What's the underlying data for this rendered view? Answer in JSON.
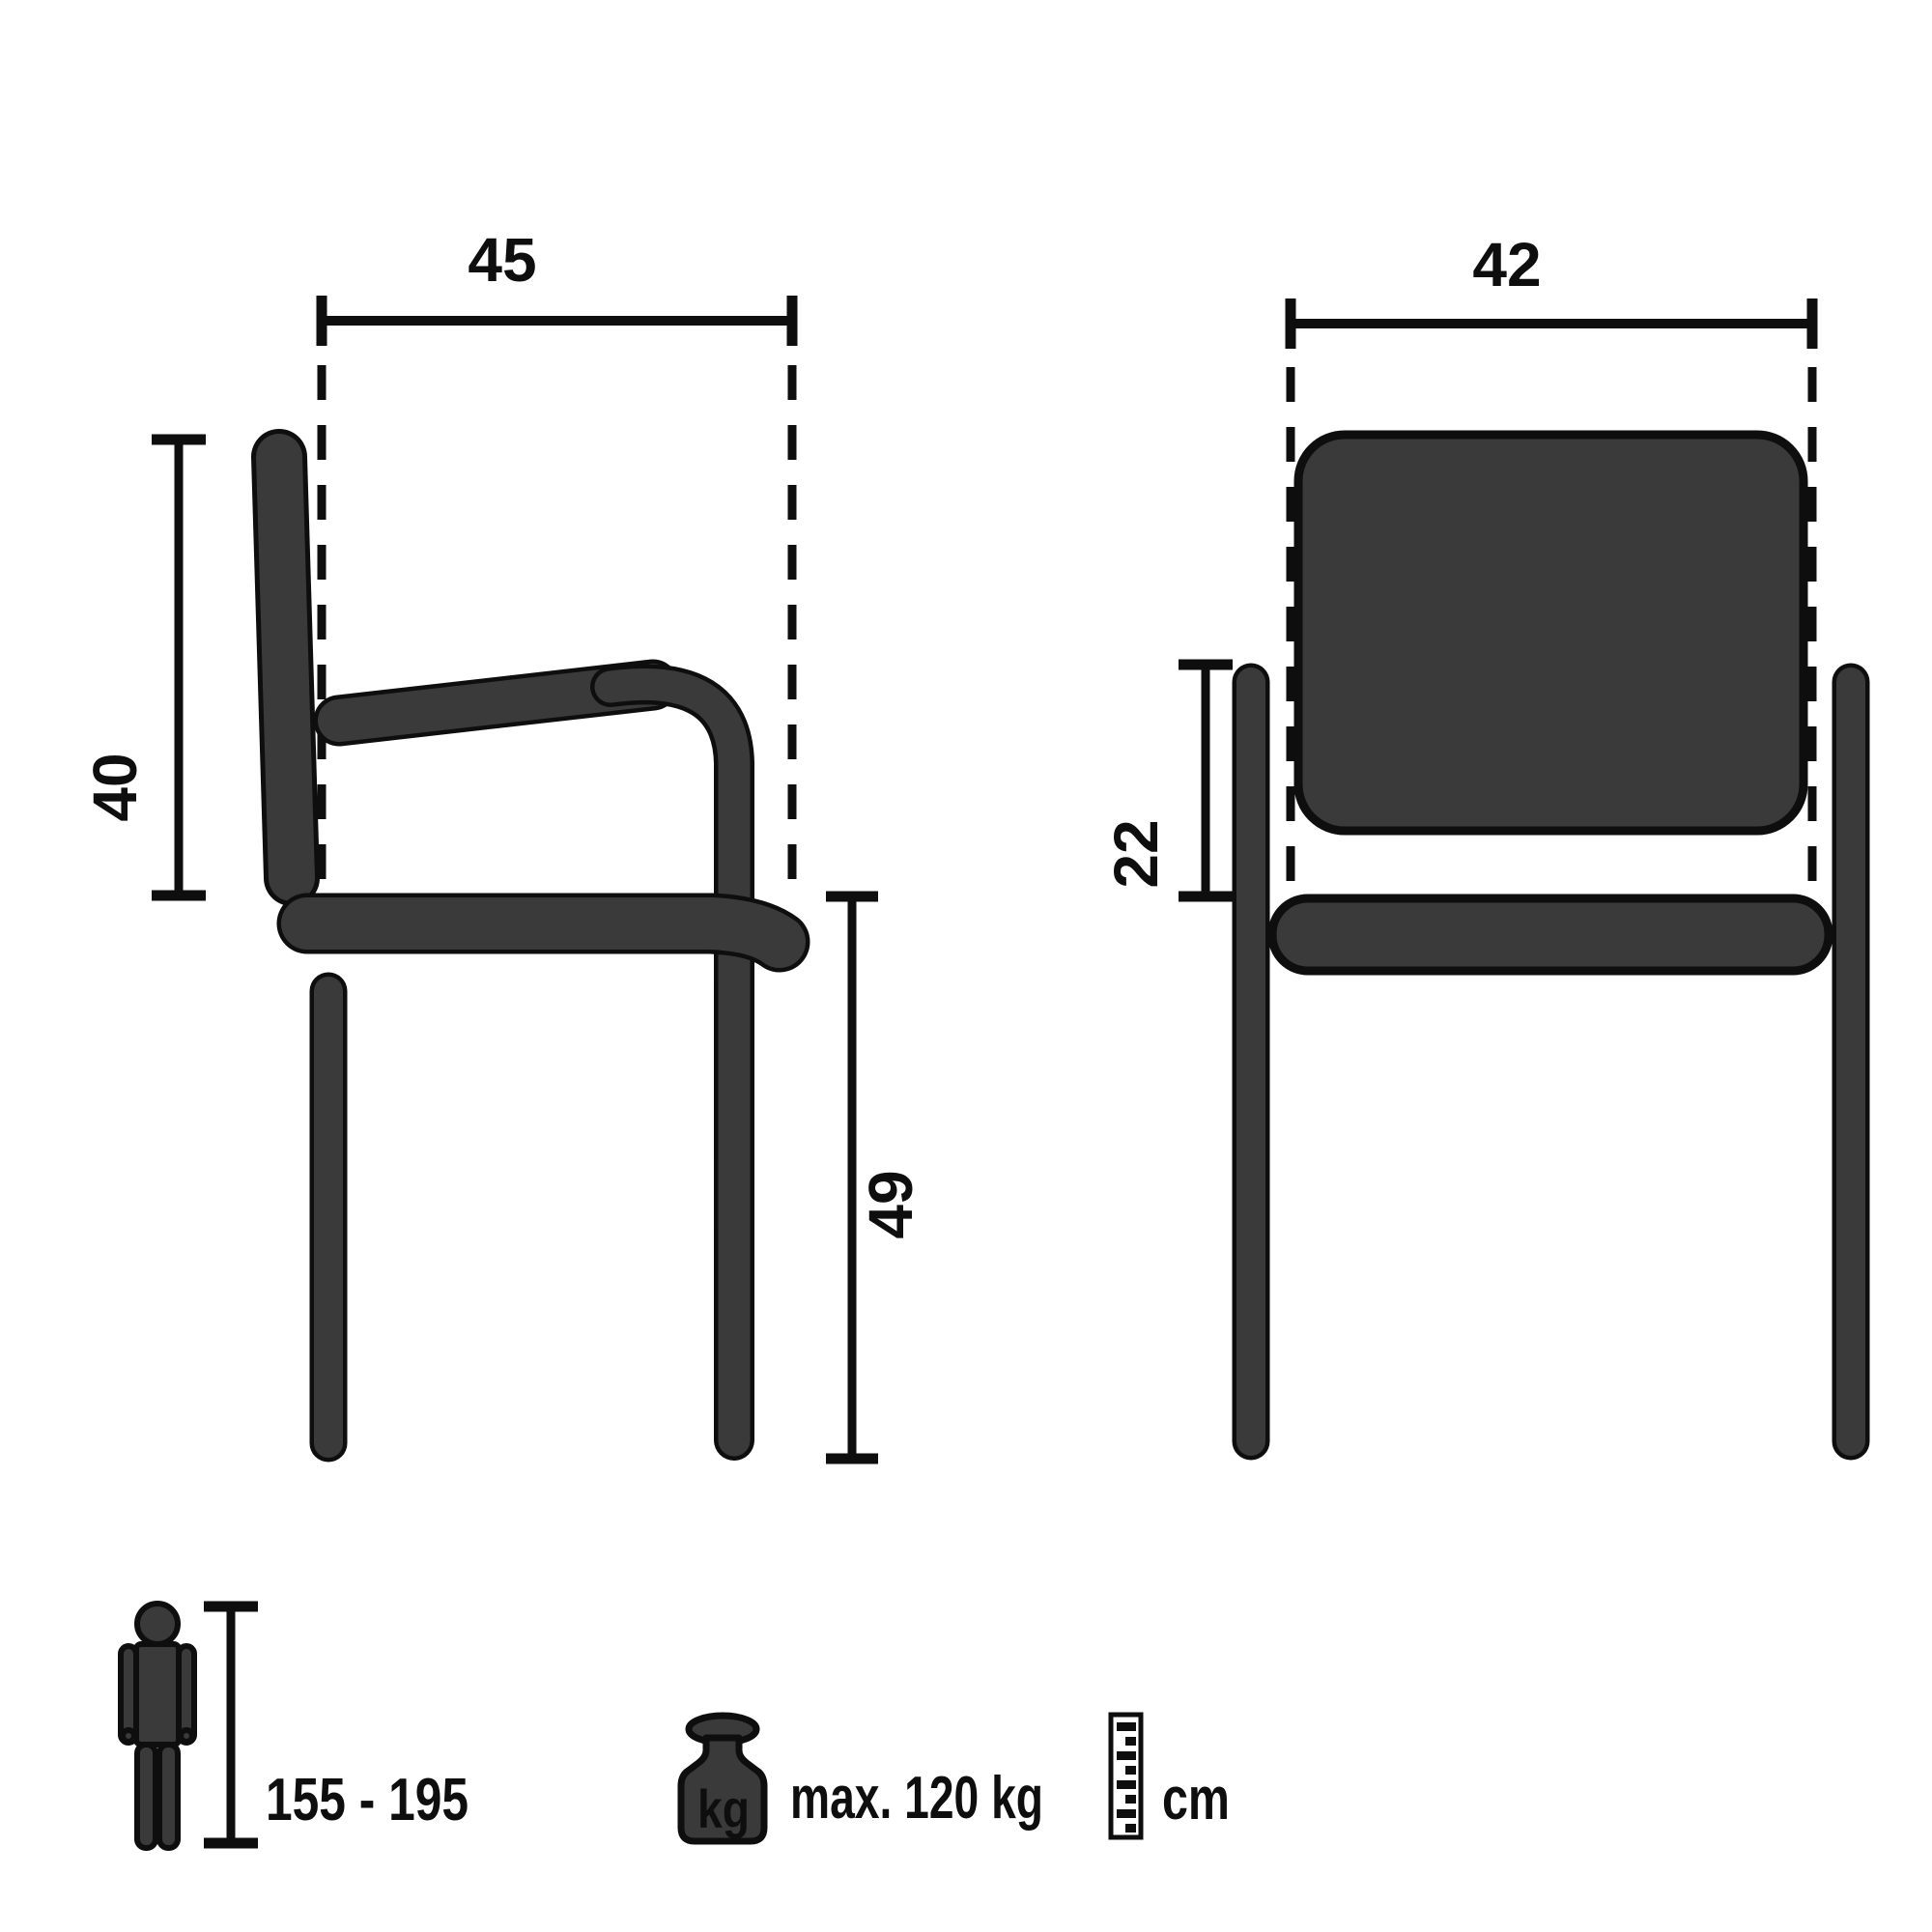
{
  "side_view": {
    "seat_depth": "45",
    "backrest_height": "40",
    "seat_height": "49"
  },
  "front_view": {
    "seat_width": "42",
    "backrest_panel_height": "22"
  },
  "legend": {
    "user_height_range": "155 - 195",
    "weight_icon_label": "kg",
    "max_load": "max. 120 kg",
    "measure_unit": "cm"
  },
  "colors": {
    "part_fill": "#3a3a3a",
    "outline": "#0e0e0e",
    "background": "#ffffff"
  }
}
